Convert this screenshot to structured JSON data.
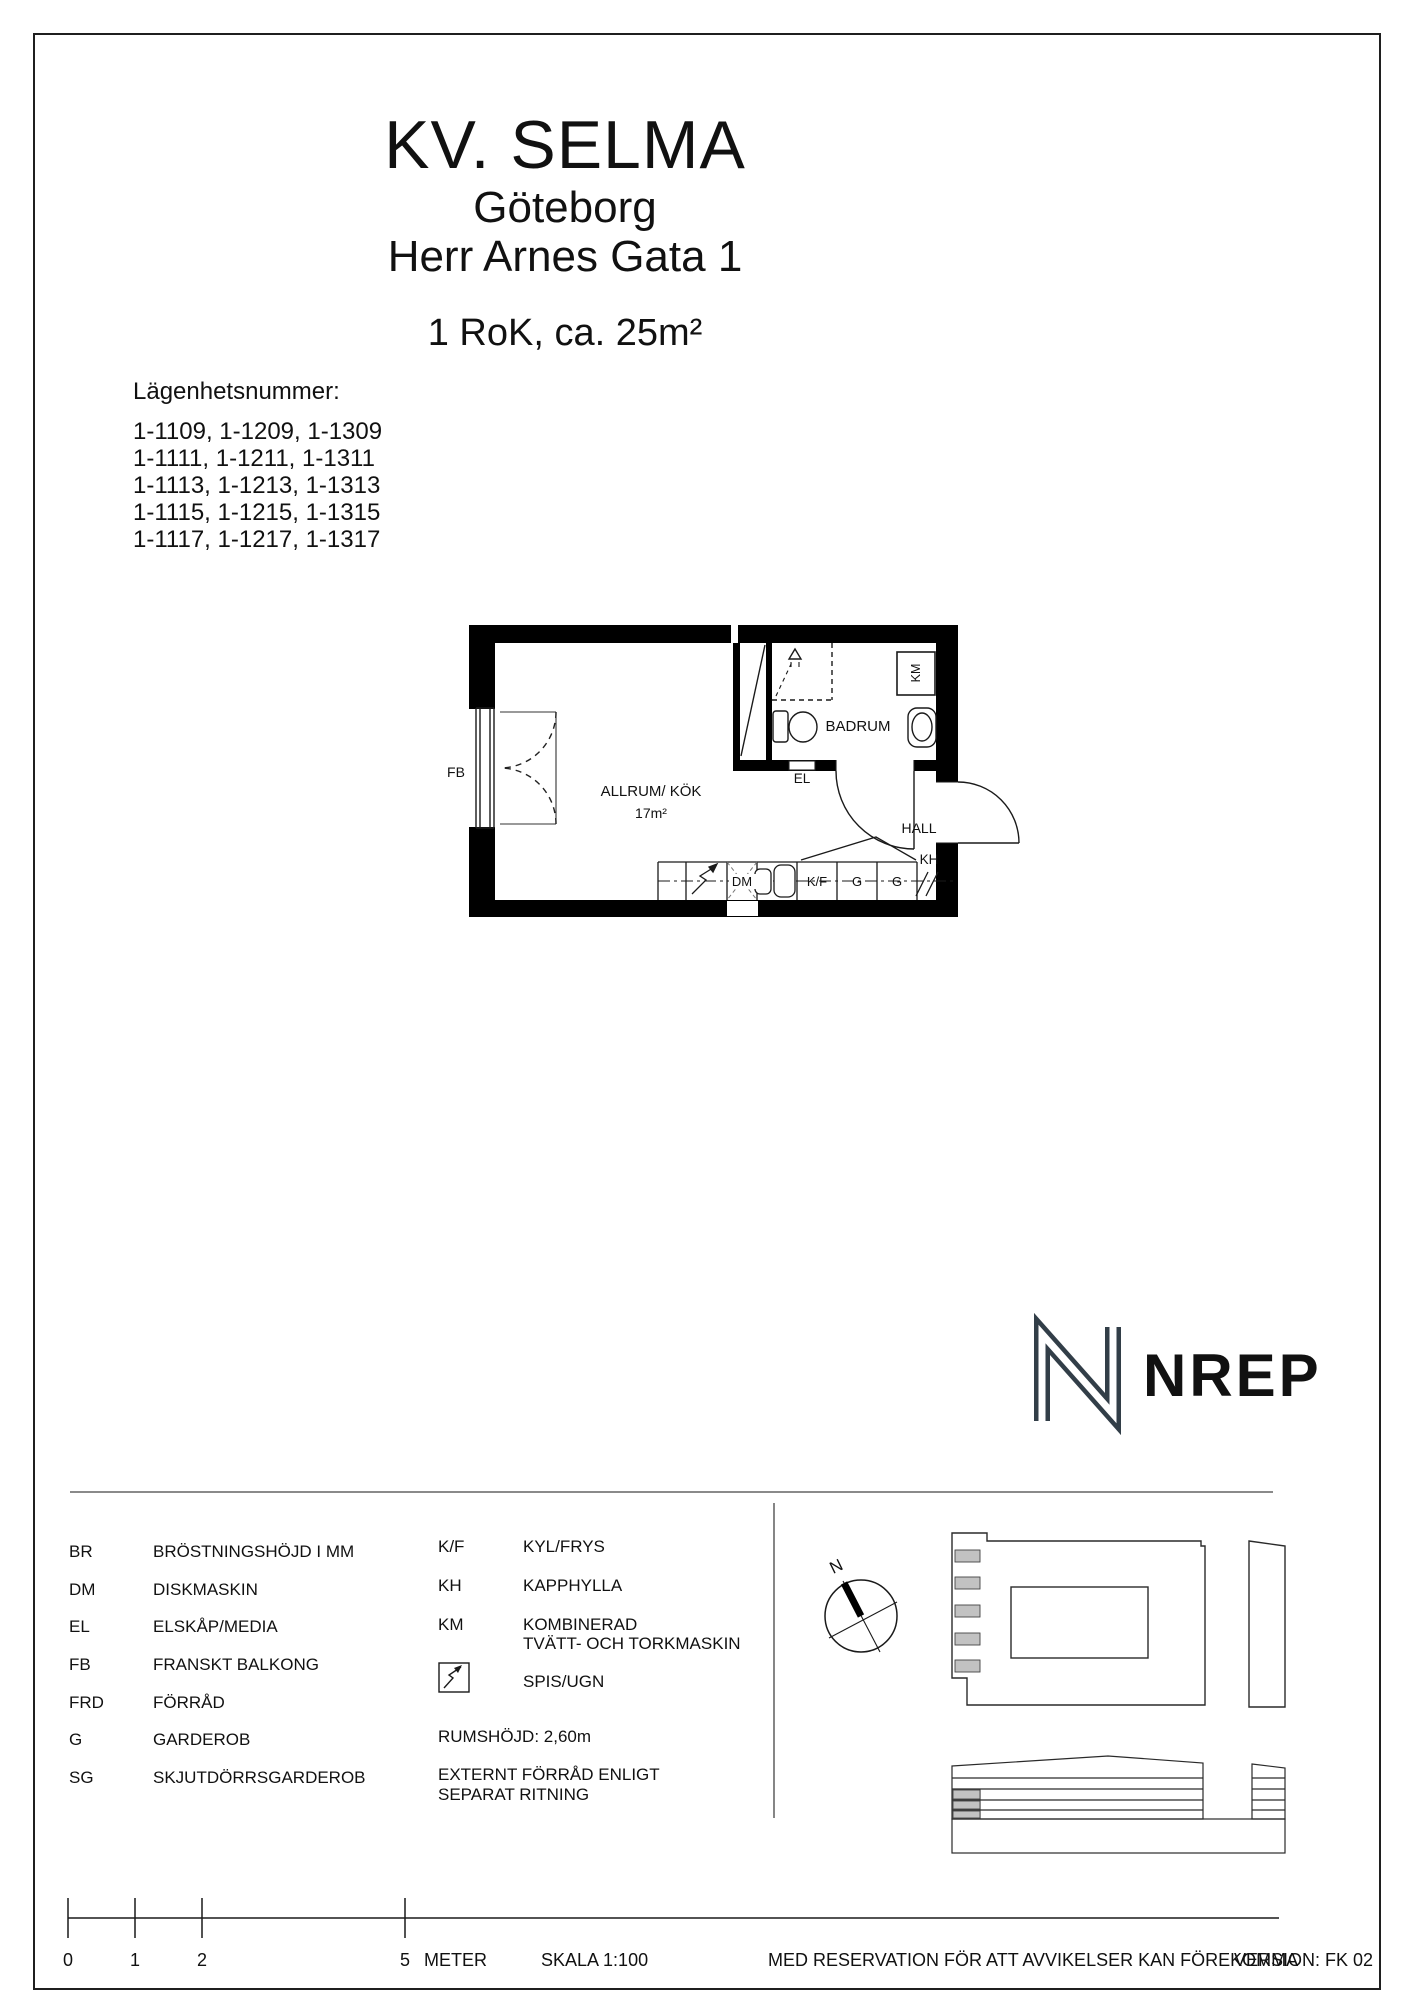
{
  "header": {
    "project": "KV. SELMA",
    "city": "Göteborg",
    "address": "Herr Arnes Gata 1",
    "size": "1 RoK, ca. 25m²"
  },
  "apartments": {
    "label": "Lägenhetsnummer:",
    "lines": [
      "1-1109, 1-1209, 1-1309",
      "1-1111, 1-1211, 1-1311",
      "1-1113, 1-1213, 1-1313",
      "1-1115, 1-1215, 1-1315",
      "1-1117, 1-1217, 1-1317"
    ]
  },
  "plan": {
    "fb": "FB",
    "room": "ALLRUM/ KÖK",
    "room_area": "17m²",
    "bathroom": "BADRUM",
    "el": "EL",
    "hall": "HALL",
    "kh": "KH",
    "km": "KM",
    "dm": "DM",
    "kf": "K/F",
    "g_left": "G",
    "g_right": "G"
  },
  "logo": {
    "text": "NREP",
    "color": "#323e48"
  },
  "compass": {
    "north": "N"
  },
  "legend": {
    "col1": [
      {
        "abbr": "BR",
        "desc": "BRÖSTNINGSHÖJD I MM"
      },
      {
        "abbr": "DM",
        "desc": "DISKMASKIN"
      },
      {
        "abbr": "EL",
        "desc": "ELSKÅP/MEDIA"
      },
      {
        "abbr": "FB",
        "desc": "FRANSKT BALKONG"
      },
      {
        "abbr": "FRD",
        "desc": "FÖRRÅD"
      },
      {
        "abbr": "G",
        "desc": "GARDEROB"
      },
      {
        "abbr": "SG",
        "desc": "SKJUTDÖRRSGARDEROB"
      }
    ],
    "col2": [
      {
        "abbr": "K/F",
        "desc": "KYL/FRYS"
      },
      {
        "abbr": "KH",
        "desc": "KAPPHYLLA"
      },
      {
        "abbr": "KM",
        "desc": "KOMBINERAD\nTVÄTT- OCH TORKMASKIN"
      }
    ],
    "stove_desc": "SPIS/UGN",
    "room_height": "RUMSHÖJD: 2,60m",
    "external": "EXTERNT FÖRRÅD ENLIGT\nSEPARAT RITNING"
  },
  "footer": {
    "ticks": [
      "0",
      "1",
      "2",
      "5"
    ],
    "unit": "METER",
    "scale": "SKALA 1:100",
    "disclaimer": "MED RESERVATION FÖR ATT AVVIKELSER KAN FÖREKOMMA",
    "version": "VERSION: FK 02"
  },
  "colors": {
    "wall": "#000000",
    "line": "#1a1a1a",
    "site_gray": "#c2c2c2",
    "logo": "#323e48"
  }
}
